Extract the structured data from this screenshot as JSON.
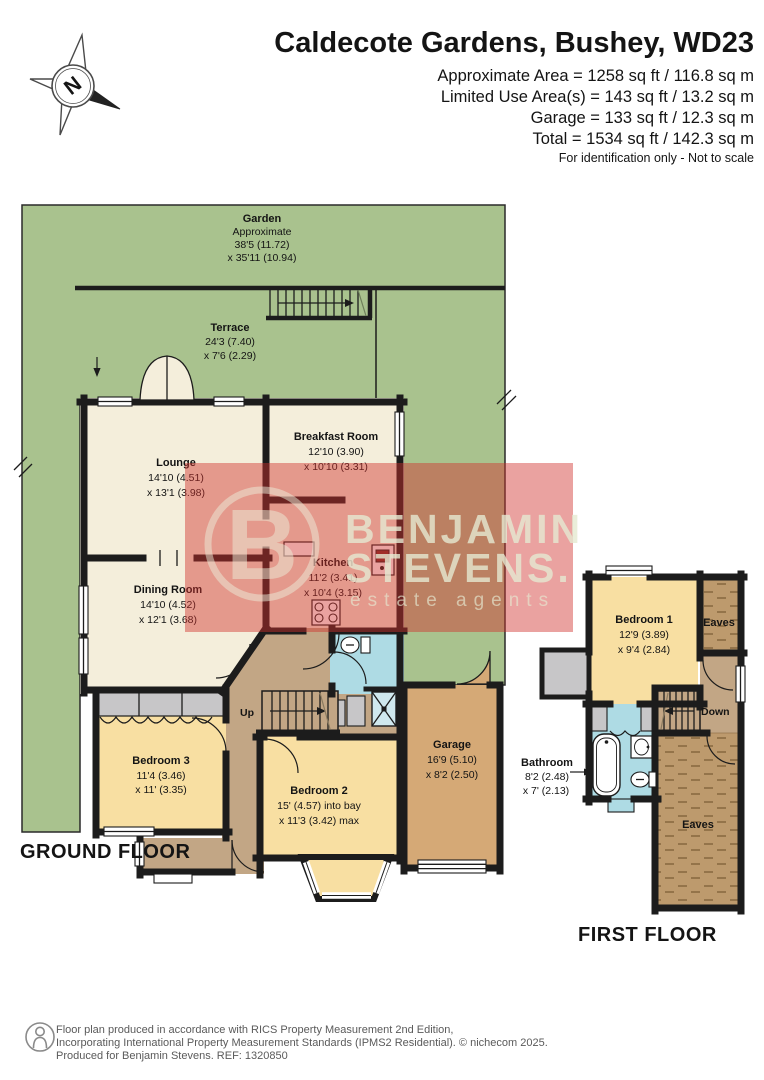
{
  "header": {
    "title": "Caldecote Gardens, Bushey, WD23",
    "lines": [
      "Approximate Area = 1258 sq ft / 116.8 sq m",
      "Limited Use Area(s) = 143 sq ft / 13.2 sq m",
      "Garage = 133 sq ft / 12.3 sq m",
      "Total = 1534 sq ft / 142.3 sq m"
    ],
    "disclaimer": "For identification only - Not to scale"
  },
  "compass": {
    "north": "N"
  },
  "ground_floor": {
    "label": "GROUND FLOOR",
    "garden": {
      "name": "Garden",
      "line1": "Approximate",
      "line2": "38'5 (11.72)",
      "line3": "x 35'11 (10.94)"
    },
    "terrace": {
      "name": "Terrace",
      "dim1": "24'3 (7.40)",
      "dim2": "x 7'6 (2.29)"
    },
    "lounge": {
      "name": "Lounge",
      "dim1": "14'10 (4.51)",
      "dim2": "x 13'1 (3.98)"
    },
    "breakfast_room": {
      "name": "Breakfast Room",
      "dim1": "12'10 (3.90)",
      "dim2": "x 10'10 (3.31)"
    },
    "kitchen": {
      "name": "Kitchen",
      "dim1": "11'2 (3.41)",
      "dim2": "x 10'4 (3.15)"
    },
    "dining_room": {
      "name": "Dining Room",
      "dim1": "14'10 (4.52)",
      "dim2": "x 12'1 (3.68)"
    },
    "bedroom3": {
      "name": "Bedroom 3",
      "dim1": "11'4 (3.46)",
      "dim2": "x 11' (3.35)"
    },
    "bedroom2": {
      "name": "Bedroom 2",
      "dim1": "15' (4.57) into bay",
      "dim2": "x 11'3 (3.42) max"
    },
    "garage": {
      "name": "Garage",
      "dim1": "16'9 (5.10)",
      "dim2": "x 8'2 (2.50)"
    },
    "stairs_label": "Up"
  },
  "first_floor": {
    "label": "FIRST FLOOR",
    "bedroom1": {
      "name": "Bedroom 1",
      "dim1": "12'9 (3.89)",
      "dim2": "x 9'4 (2.84)"
    },
    "bathroom": {
      "name": "Bathroom",
      "dim1": "8'2 (2.48)",
      "dim2": "x 7' (2.13)"
    },
    "eaves_top": "Eaves",
    "eaves_bottom": "Eaves",
    "stairs_label": "Down"
  },
  "watermark": {
    "logo_letter": "B",
    "line1": "BENJAMIN",
    "line2": "STEVENS.",
    "line3": "estate agents"
  },
  "footer": {
    "lines": [
      "Floor plan produced in accordance with RICS Property Measurement 2nd Edition,",
      "Incorporating International Property Measurement Standards (IPMS2 Residential).   © nichecom 2025.",
      "Produced for Benjamin Stevens.   REF: 1320850"
    ]
  },
  "colors": {
    "garden_green": "#a9c28e",
    "room_cream": "#f4eedb",
    "bedroom_yellow": "#f8dfa2",
    "hall_tan": "#c2a685",
    "garage_tan": "#d5a976",
    "eaves_brown": "#bd9a6d",
    "bathroom_blue": "#aedbe4",
    "closet_gray": "#c7c6c8",
    "wall_black": "#1c1c1c",
    "watermark_red": "#d0312d",
    "watermark_text": "#e6ead2",
    "footer_gray": "#5a5a5a"
  }
}
